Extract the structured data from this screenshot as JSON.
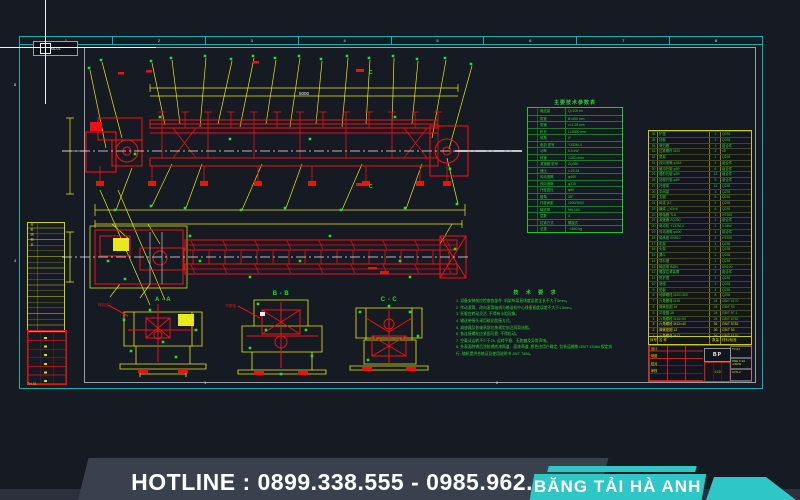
{
  "sheet": {
    "corner_label": "A0-01",
    "top_zones": [
      "1",
      "2",
      "3",
      "4",
      "5",
      "6",
      "7",
      "8"
    ],
    "left_zones": [
      "8",
      "4"
    ],
    "bottom_zones": [
      "1",
      "2"
    ],
    "strip_label": "TH-01",
    "frame_color": "#18b2ae"
  },
  "drawing": {
    "dim_label": "5000",
    "cut_label": "C",
    "section_a_label": "A - A",
    "section_b_label": "B - B",
    "section_c_label": "C - C",
    "red_note_a": "焊后加工",
    "red_note_b": "托辊组",
    "left_table_note": "材料明细表"
  },
  "param_table": {
    "title": "主要技术参数表",
    "rows": [
      {
        "l": "输送量",
        "v": "Q=100 t/h"
      },
      {
        "l": "带宽",
        "v": "B=650 mm"
      },
      {
        "l": "带速",
        "v": "v=1.25 m/s"
      },
      {
        "l": "机长",
        "v": "L=5000 mm"
      },
      {
        "l": "倾角",
        "v": "0°"
      },
      {
        "l": "电机 型号",
        "v": "Y132M-4"
      },
      {
        "l": "功率",
        "v": "5.5 kW"
      },
      {
        "l": "转速",
        "v": "1440 r/min"
      },
      {
        "l": "减速器 型号",
        "v": "ZQ350"
      },
      {
        "l": "速比",
        "v": "i=23.34"
      },
      {
        "l": "传动滚筒",
        "v": "φ400"
      },
      {
        "l": "改向滚筒",
        "v": "φ315"
      },
      {
        "l": "托辊直径",
        "v": "φ89"
      },
      {
        "l": "槽角",
        "v": "35°"
      },
      {
        "l": "托辊间距",
        "v": "1000/3000"
      },
      {
        "l": "输送带",
        "v": "NN-100"
      },
      {
        "l": "层数",
        "v": "4"
      },
      {
        "l": "拉紧方式",
        "v": "螺旋式"
      },
      {
        "l": "总重",
        "v": "~1800 kg"
      }
    ]
  },
  "bom_table": {
    "header": {
      "n": "序号",
      "name": "名  称",
      "q": "数量",
      "m": "材料/标准"
    },
    "rows": [
      {
        "n": "36",
        "name": "护罩",
        "q": "2",
        "m": "Q235"
      },
      {
        "n": "35",
        "name": "挡板",
        "q": "2",
        "m": "Q235"
      },
      {
        "n": "34",
        "name": "清扫器",
        "q": "1",
        "m": "组合件"
      },
      {
        "n": "33",
        "name": "拉紧螺杆 M20",
        "q": "2",
        "m": "45"
      },
      {
        "n": "32",
        "name": "尾架",
        "q": "1",
        "m": "Q235"
      },
      {
        "n": "31",
        "name": "改向滚筒 φ315",
        "q": "1",
        "m": "组合件"
      },
      {
        "n": "30",
        "name": "缓冲托辊 φ89",
        "q": "6",
        "m": "组合件"
      },
      {
        "n": "29",
        "name": "槽形托辊 φ89",
        "q": "14",
        "m": "组合件"
      },
      {
        "n": "28",
        "name": "回程托辊 φ89",
        "q": "5",
        "m": "组合件"
      },
      {
        "n": "27",
        "name": "托辊架",
        "q": "14",
        "m": "Q235"
      },
      {
        "n": "26",
        "name": "中间架",
        "q": "3",
        "m": "Q235"
      },
      {
        "n": "25",
        "name": "支腿",
        "q": "8",
        "m": "Q235"
      },
      {
        "n": "24",
        "name": "纵梁 [12",
        "q": "2",
        "m": "Q235"
      },
      {
        "n": "23",
        "name": "横梁 ∠63×6",
        "q": "6",
        "m": "Q235"
      },
      {
        "n": "22",
        "name": "联轴器 TL6",
        "q": "1",
        "m": "HT200"
      },
      {
        "n": "21",
        "name": "减速器 ZQ350",
        "q": "1",
        "m": "组合件"
      },
      {
        "n": "20",
        "name": "电动机 Y132M-4",
        "q": "1",
        "m": "5.5kW"
      },
      {
        "n": "19",
        "name": "传动滚筒 φ400",
        "q": "1",
        "m": "组合件"
      },
      {
        "n": "18",
        "name": "轴承座 SN510",
        "q": "2",
        "m": "HT200"
      },
      {
        "n": "17",
        "name": "机架",
        "q": "1",
        "m": "Q235"
      },
      {
        "n": "16",
        "name": "头架",
        "q": "1",
        "m": "Q235"
      },
      {
        "n": "15",
        "name": "漏斗",
        "q": "1",
        "m": "Q235"
      },
      {
        "n": "14",
        "name": "导料槽",
        "q": "1",
        "m": "Q235"
      },
      {
        "n": "13",
        "name": "输送带 B650",
        "q": "1",
        "m": "NN100"
      },
      {
        "n": "12",
        "name": "螺旋拉紧装置",
        "q": "2",
        "m": "组合件"
      },
      {
        "n": "11",
        "name": "防护罩",
        "q": "1",
        "m": "Q235"
      },
      {
        "n": "10",
        "name": "底座",
        "q": "2",
        "m": "Q235"
      },
      {
        "n": "9",
        "name": "垫板",
        "q": "4",
        "m": "Q235"
      },
      {
        "n": "8",
        "name": "地脚螺栓 M20×300",
        "q": "8",
        "m": "Q235"
      },
      {
        "n": "7",
        "name": "六角螺母 M16",
        "q": "24",
        "m": "GB/T 6170"
      },
      {
        "n": "6",
        "name": "弹簧垫圈 16",
        "q": "24",
        "m": "GB/T 93"
      },
      {
        "n": "5",
        "name": "平垫圈 16",
        "q": "24",
        "m": "GB/T 97.1"
      },
      {
        "n": "4",
        "name": "六角螺栓 M16×50",
        "q": "24",
        "m": "GB/T 5782"
      },
      {
        "n": "3",
        "name": "六角螺栓 M12×40",
        "q": "36",
        "m": "GB/T 5782"
      },
      {
        "n": "2",
        "name": "弹簧垫圈 12",
        "q": "36",
        "m": "GB/T 93"
      },
      {
        "n": "1",
        "name": "六角螺母 M12",
        "q": "36",
        "m": "GB/T 6170"
      }
    ]
  },
  "notes": {
    "title": "技 术 要 求",
    "lines": [
      "1. 设备安装前应检查各部件, 机架纵梁直线度误差全长不大于5mm。",
      "2. 传动滚筒、改向滚筒轴线与输送机中心线垂直度误差不大于1.5mm。",
      "3. 托辊应转动灵活, 不得有卡阻现象。",
      "4. 输送带接头采用硫化胶接方式。",
      "5. 减速器及各轴承部位按规定加注润滑油脂。",
      "6. 各连接螺栓应紧固可靠, 不得松动。",
      "7. 空载试运转不少于2h, 运转平稳、无跑偏及异常声响。",
      "8. 外表面除锈后涂防锈底漆两道、面漆两道, 颜色由用户确定, 包装运输按 GB/T 13384 规定执行, 随机提供合格证及使用说明书 JB/T 7856。"
    ]
  },
  "title_block": {
    "code": "BP",
    "scale": "1:10",
    "sig_labels": [
      "设计",
      "制图",
      "校对",
      "审核"
    ],
    "right_cells": [
      "TY-04",
      "PRE 6.3A 4.5DW",
      "AVN-2"
    ]
  },
  "banner": {
    "hotline": "HOTLINE : 0899.338.555 - 0985.962.451",
    "brand": "BĂNG TẢI HÀ ANH",
    "accent": "#2dc7c7"
  }
}
